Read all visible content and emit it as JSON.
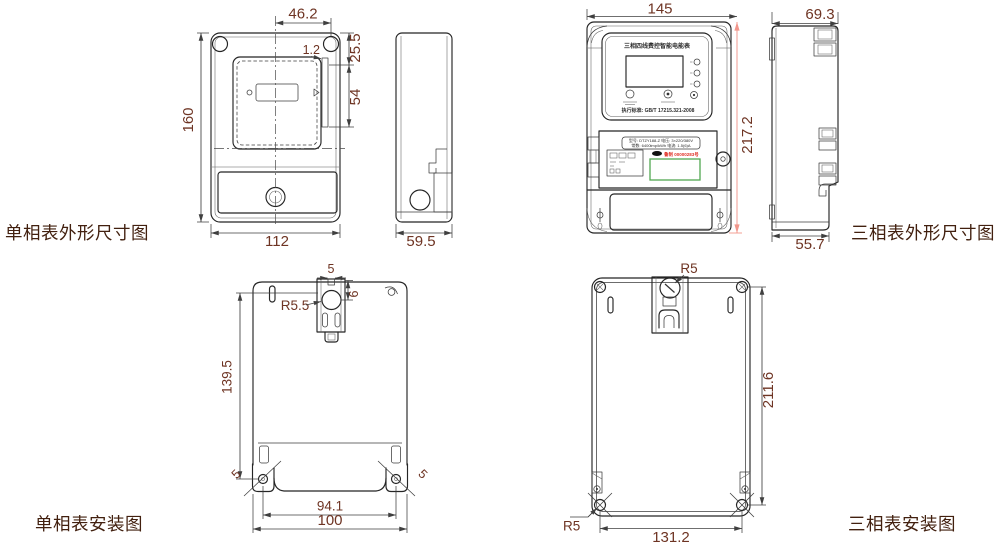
{
  "colors": {
    "line": "#252525",
    "dimension_text": "#6e3423",
    "section_label_text": "#42200f",
    "highlight_dimension_line": "#f2968b",
    "label_green_box": "#52a852",
    "serial_red_text": "#e03226"
  },
  "sections": {
    "single_outline": {
      "title": "单相表外形尺寸图",
      "dims": {
        "top_width": "46.2",
        "gap": "1.2",
        "upper_height": "25.5",
        "rail_height": "54",
        "body_height": "160",
        "body_width": "112",
        "side_depth": "59.5"
      }
    },
    "three_outline": {
      "title": "三相表外形尺寸图",
      "dims": {
        "body_width": "145",
        "body_height": "217.2",
        "side_top_depth": "69.3",
        "side_bottom_depth": "55.7"
      },
      "faceplate": {
        "name": "三相四线费控智能电能表",
        "standard": "执行标准: GB/T 17215.321-2008",
        "spec_line1": "型号: DTZY188-Z  电压: 3×220/380V",
        "spec_line2": "常数: 6400imp/kWh  电流: 1.5(6)A",
        "serial": "鲁制 00000283号"
      }
    },
    "single_install": {
      "title": "单相表安装图",
      "dims": {
        "hook_slot_width": "5",
        "hook_depth": "6",
        "hook_hole_radius": "R5.5",
        "vertical_hole_span": "139.5",
        "left_hole": "5",
        "right_hole": "5",
        "hole_span": "94.1",
        "outer_span": "100"
      }
    },
    "three_install": {
      "title": "三相表安装图",
      "dims": {
        "hook_hole_radius": "R5",
        "vertical_hole_span": "211.6",
        "corner_hole_radius": "R5",
        "hole_span": "131.2"
      }
    }
  }
}
